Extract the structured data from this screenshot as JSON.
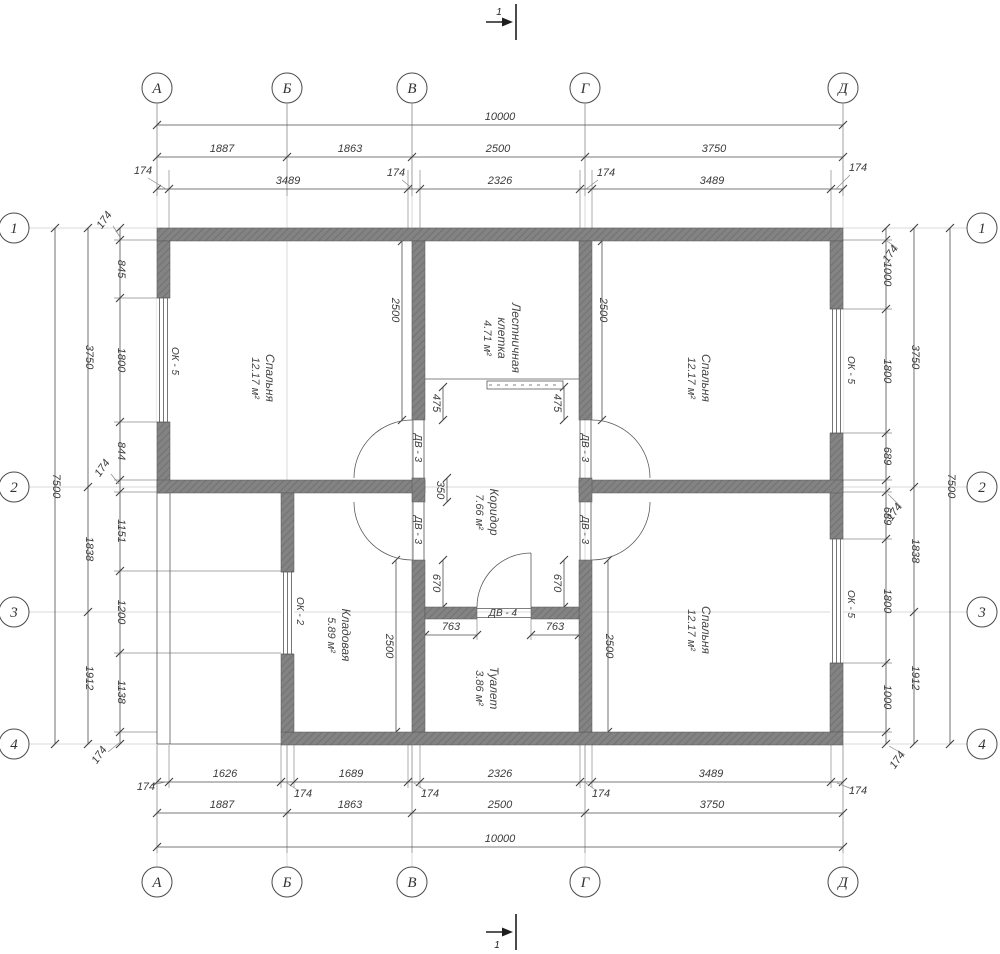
{
  "colors": {
    "wall": "#7d7d7d",
    "line": "#4d4d4d",
    "text": "#3b3b3b",
    "background": "#ffffff"
  },
  "axes": {
    "cols": [
      "А",
      "Б",
      "В",
      "Г",
      "Д"
    ],
    "rows": [
      "1",
      "2",
      "3",
      "4"
    ]
  },
  "section": {
    "label": "1"
  },
  "dims": {
    "top": {
      "overall": "10000",
      "row2": [
        "1887",
        "1863",
        "2500",
        "3750"
      ],
      "row3": [
        "174",
        "3489",
        "174",
        "2326",
        "174",
        "3489",
        "174"
      ]
    },
    "bottom": {
      "overall": "10000",
      "row1": [
        "174",
        "1626",
        "174",
        "1689",
        "174",
        "2326",
        "174",
        "3489",
        "174"
      ],
      "row2": [
        "1887",
        "1863",
        "2500",
        "3750"
      ]
    },
    "left": {
      "overall": "7500",
      "spans": [
        "3750",
        "1838",
        "1912"
      ],
      "inner": [
        "174",
        "845",
        "1800",
        "844",
        "174",
        "1151",
        "1200",
        "1138",
        "174"
      ]
    },
    "right": {
      "overall": "7500",
      "spans": [
        "3750",
        "1838",
        "1912"
      ],
      "inner": [
        "174",
        "1000",
        "1800",
        "689",
        "174",
        "689",
        "1800",
        "1000",
        "174"
      ]
    },
    "interior": {
      "w2500": "2500",
      "w475": "475",
      "w350": "350",
      "w670": "670",
      "w763": "763"
    }
  },
  "rooms": [
    {
      "name": "Спальня",
      "area": "12.17 м²"
    },
    {
      "name": "Лестничная",
      "name2": "клетка",
      "area": "4.71 м²"
    },
    {
      "name": "Спальня",
      "area": "12.17 м²"
    },
    {
      "name": "Коридор",
      "area": "7.66 м²"
    },
    {
      "name": "Кладовая",
      "area": "5.89 м²"
    },
    {
      "name": "Туалет",
      "area": "3.86 м²"
    },
    {
      "name": "Спальня",
      "area": "12.17 м²"
    }
  ],
  "openings": {
    "window_large": "ОК - 5",
    "window_small": "ОК - 2",
    "door_interior": "ДВ - 3",
    "door_toilet": "ДВ - 4"
  }
}
